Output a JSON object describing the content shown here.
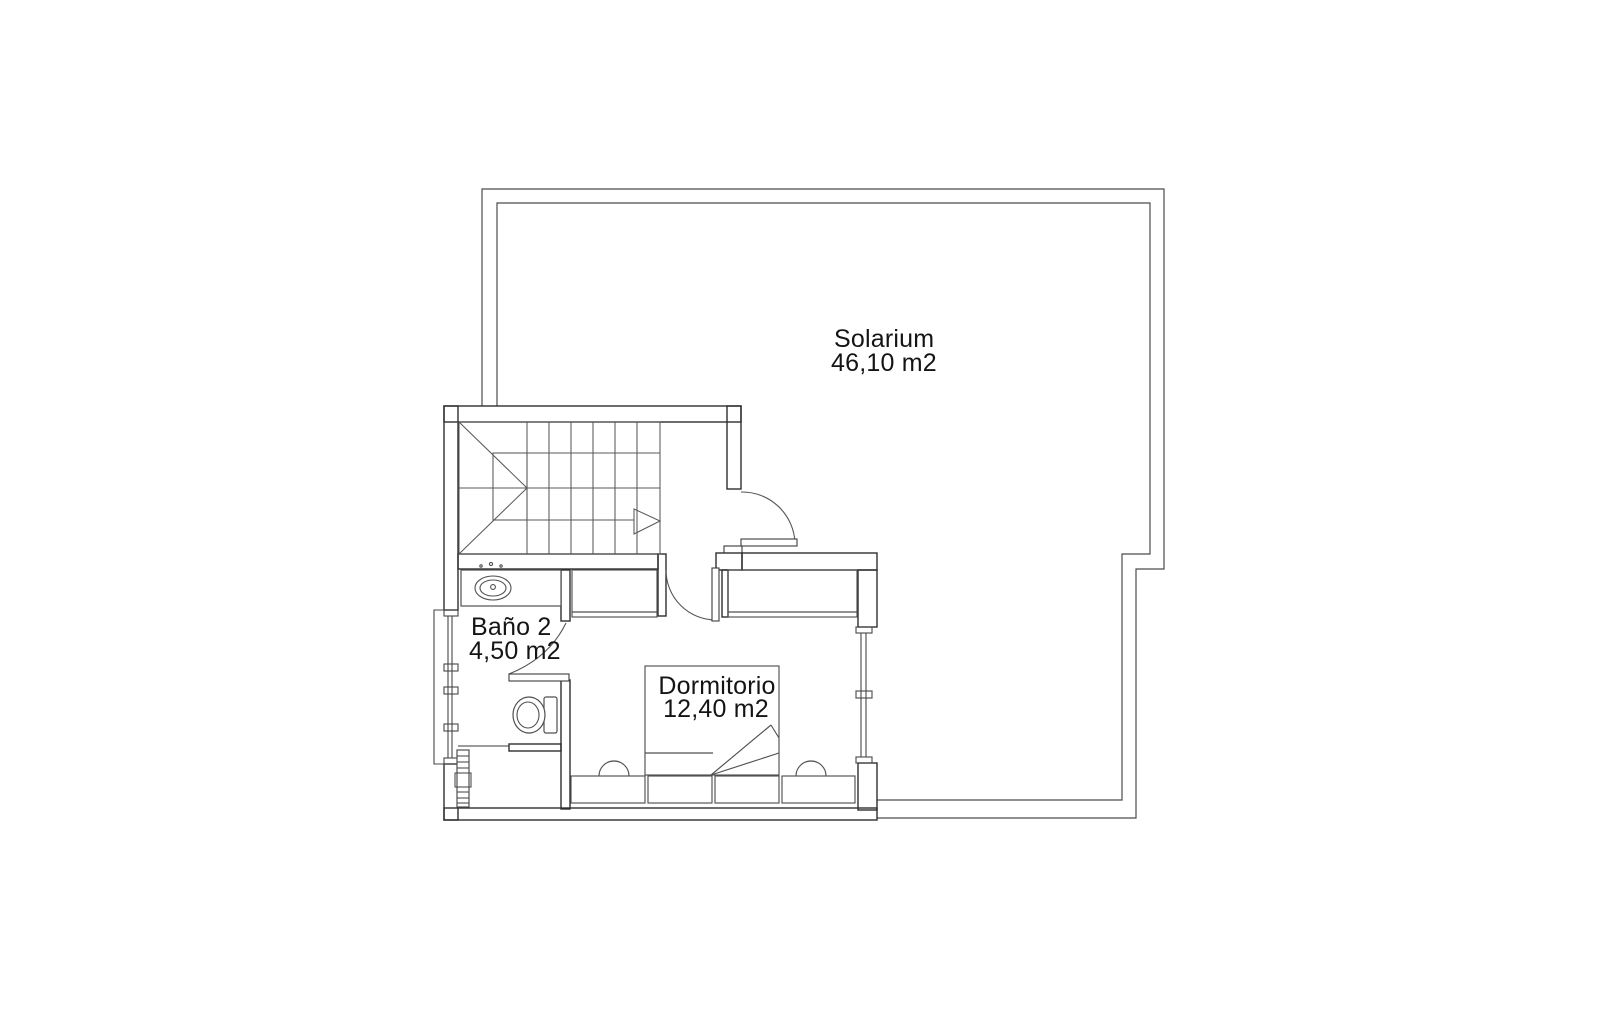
{
  "page": {
    "background": "#ffffff",
    "line_color": "#3a3a3a",
    "text_color": "#141414",
    "drawing_type": "floor-plan"
  },
  "rooms": [
    {
      "id": "solarium",
      "name": "Solarium",
      "area": "46,10 m2"
    },
    {
      "id": "bano2",
      "name": "Baño 2",
      "area": "4,50 m2"
    },
    {
      "id": "dormitorio",
      "name": "Dormitorio",
      "area": "12,40 m2"
    }
  ]
}
